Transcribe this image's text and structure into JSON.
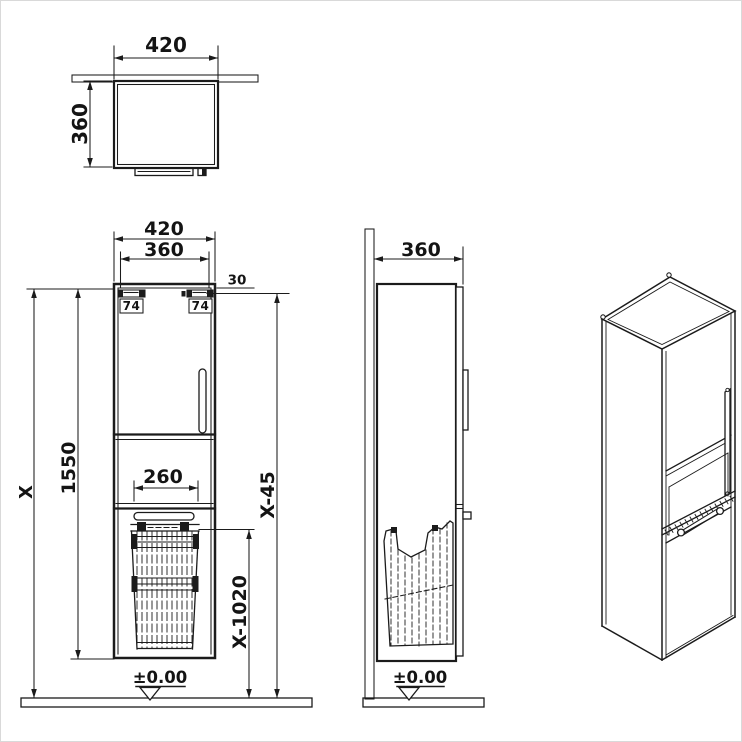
{
  "drawing": {
    "kind": "bathroom-tall-cabinet-technical-drawing",
    "style": {
      "line_color": "#1b1b1b",
      "background": "#ffffff"
    },
    "views": {
      "top": {
        "width": "420",
        "depth": "360"
      },
      "front": {
        "width": "420",
        "bracket_span": "360",
        "bracket_offset": "30",
        "bracket_left": "74",
        "bracket_right": "74",
        "total_height": "X",
        "body_height": "1550",
        "basket_width": "260",
        "dim_upper_right": "X-45",
        "dim_lower_right": "X-1020",
        "datum": "±0.00"
      },
      "side": {
        "depth": "360",
        "datum": "±0.00"
      }
    }
  }
}
